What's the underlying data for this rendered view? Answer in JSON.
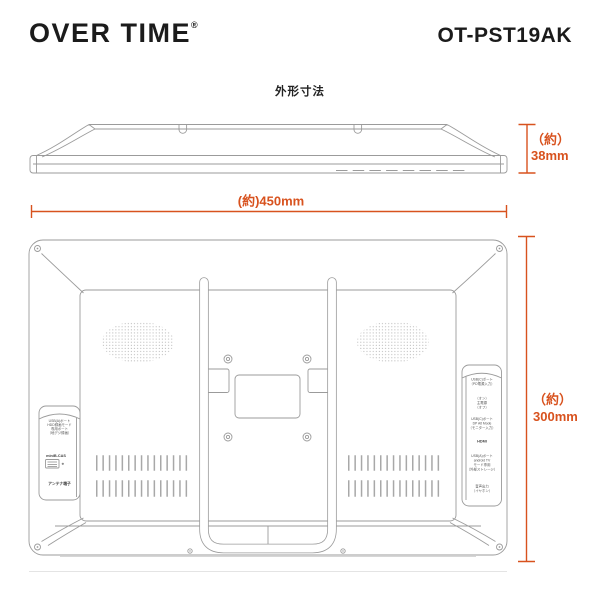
{
  "header": {
    "brand": "OVER TIME",
    "reg": "®",
    "model": "OT-PST19AK"
  },
  "section_title": "外形寸法",
  "colors": {
    "accent": "#d8521e",
    "line": "#9b9b9b"
  },
  "dimensions": {
    "depth": {
      "line1": "（約）",
      "line2": "38mm"
    },
    "width": {
      "label": "(約)450mm"
    },
    "height": {
      "line1": "（約）",
      "line2": "300mm"
    }
  },
  "back_view": {
    "left_panel": {
      "usb_block": [
        "USB(A)ポート",
        "HDD録画モード",
        "専用ポート",
        "（地デジ録画）"
      ],
      "bcas_label": "miniB-CAS",
      "antenna_label": "アンテナ端子"
    },
    "right_panel": {
      "block1": [
        "USB(C)ポート",
        "（PD電源入力）"
      ],
      "block2": [
        "（オン）",
        "主電源",
        "（オフ）"
      ],
      "block3": [
        "USB(C)ポート",
        "DP Alt Mode",
        "（モニター入力）"
      ],
      "block4": [
        "HDMI"
      ],
      "block5": [
        "USB(A)ポート",
        "android TV",
        "モード専用",
        "（外部ストレージ）"
      ],
      "block6": [
        "音声出力",
        "（イヤホン）"
      ]
    }
  }
}
